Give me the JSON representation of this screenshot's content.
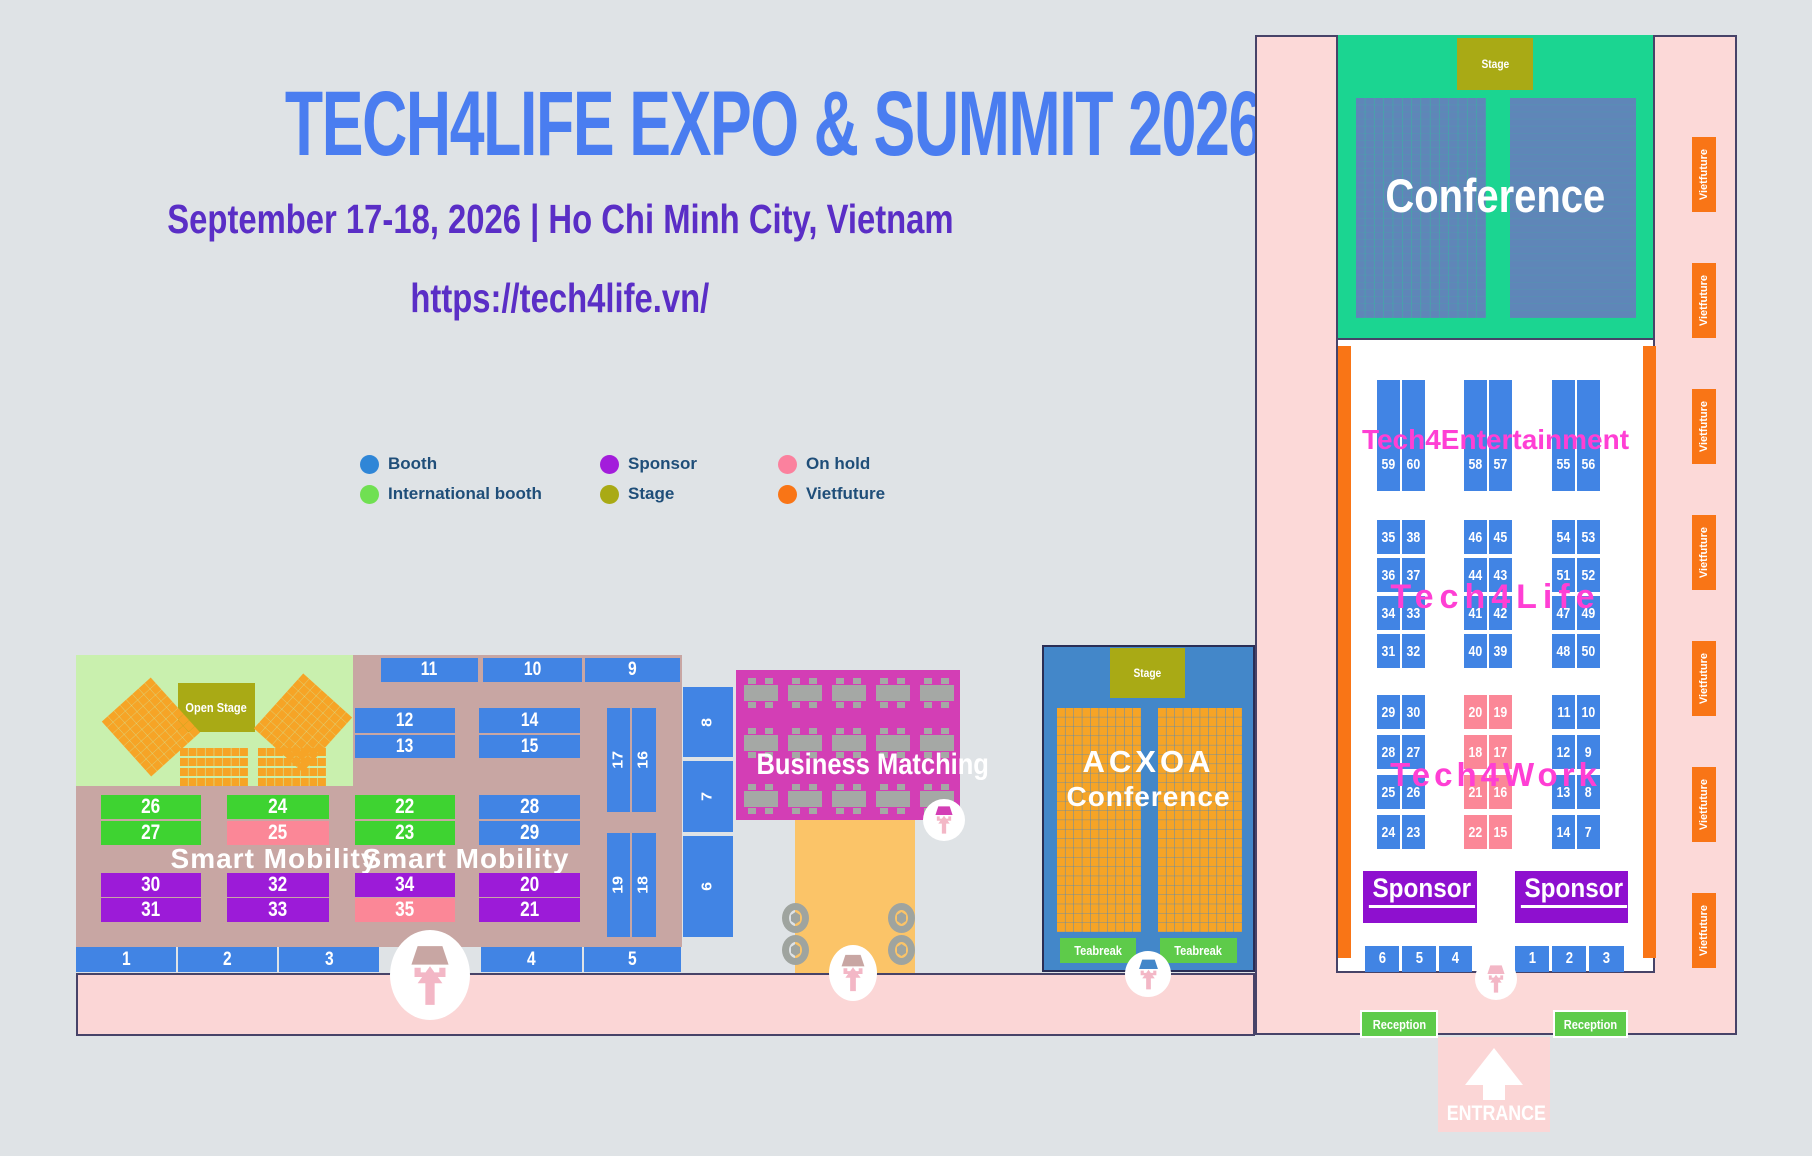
{
  "header": {
    "title": "TECH4LIFE EXPO & SUMMIT 2026",
    "subtitle": "September 17-18, 2026 | Ho Chi Minh City, Vietnam",
    "url": "https://tech4life.vn/"
  },
  "legend": {
    "items": [
      {
        "label": "Booth",
        "color": "#2f86d7"
      },
      {
        "label": "International booth",
        "color": "#70e052"
      },
      {
        "label": "Sponsor",
        "color": "#a31ddb"
      },
      {
        "label": "Stage",
        "color": "#a9aa15"
      },
      {
        "label": "On hold",
        "color": "#fb819e"
      },
      {
        "label": "Vietfuture",
        "color": "#f97516"
      }
    ]
  },
  "colors": {
    "booth": "#4184e4",
    "international": "#3ed331",
    "sponsor": "#9c1bd8",
    "onhold": "#fb8797",
    "stage": "#a9aa15",
    "vietfuture": "#f97516",
    "hall_green": "#1bd591",
    "acxoa_blue": "#4387c9",
    "business_magenta": "#d33eb5",
    "zone_label_magenta": "#ff3fd4",
    "tan": "#c8a6a3",
    "light_green": "#c9f0ae",
    "corridor_orange": "#fbc468",
    "pink_building": "#fcd9d8",
    "pink_walkway": "#fbd6d6",
    "reception_green": "#5ecb4a",
    "seat_orange": "#f6a426",
    "seat_blue": "#5f86b8",
    "title_blue": "#4a7df0",
    "subtitle_purple": "#5a2ec6",
    "legend_text": "#1f4e79",
    "border_navy": "#474368",
    "table_gray": "#a5a8a5"
  },
  "left_hall": {
    "open_stage_label": "Open Stage",
    "smart_mobility_labels": [
      "Smart Mobility",
      "Smart Mobility"
    ],
    "booths": [
      {
        "label": "11",
        "type": "booth"
      },
      {
        "label": "10",
        "type": "booth"
      },
      {
        "label": "9",
        "type": "booth"
      },
      {
        "label": "12",
        "type": "booth"
      },
      {
        "label": "13",
        "type": "booth"
      },
      {
        "label": "14",
        "type": "booth"
      },
      {
        "label": "15",
        "type": "booth"
      },
      {
        "label": "17",
        "type": "booth"
      },
      {
        "label": "16",
        "type": "booth"
      },
      {
        "label": "19",
        "type": "booth"
      },
      {
        "label": "18",
        "type": "booth"
      },
      {
        "label": "8",
        "type": "booth"
      },
      {
        "label": "7",
        "type": "booth"
      },
      {
        "label": "6",
        "type": "booth"
      },
      {
        "label": "1",
        "type": "booth"
      },
      {
        "label": "2",
        "type": "booth"
      },
      {
        "label": "3",
        "type": "booth"
      },
      {
        "label": "4",
        "type": "booth"
      },
      {
        "label": "5",
        "type": "booth"
      }
    ],
    "block_booths": [
      {
        "label": "26",
        "type": "international"
      },
      {
        "label": "27",
        "type": "international"
      },
      {
        "label": "24",
        "type": "international"
      },
      {
        "label": "25",
        "type": "onhold"
      },
      {
        "label": "22",
        "type": "international"
      },
      {
        "label": "23",
        "type": "international"
      },
      {
        "label": "28",
        "type": "booth"
      },
      {
        "label": "29",
        "type": "booth"
      },
      {
        "label": "30",
        "type": "sponsor"
      },
      {
        "label": "31",
        "type": "sponsor"
      },
      {
        "label": "32",
        "type": "sponsor"
      },
      {
        "label": "33",
        "type": "sponsor"
      },
      {
        "label": "34",
        "type": "sponsor"
      },
      {
        "label": "35",
        "type": "onhold"
      },
      {
        "label": "20",
        "type": "sponsor"
      },
      {
        "label": "21",
        "type": "sponsor"
      }
    ]
  },
  "business_matching": {
    "label": "Business Matching",
    "table_rows": 3,
    "table_cols": 5
  },
  "acxoa": {
    "stage_label": "Stage",
    "line1": "ACXOA",
    "line2": "Conference",
    "teabreaks": [
      "Teabreak",
      "Teabreak"
    ]
  },
  "right_hall": {
    "conference_label": "Conference",
    "stage_label": "Stage",
    "vietfuture_tabs": [
      "Vietfuture",
      "Vietfuture",
      "Vietfuture",
      "Vietfuture",
      "Vietfuture",
      "Vietfuture",
      "Vietfuture"
    ],
    "zones": [
      {
        "label": "Tech4Entertainment",
        "groups": [
          [
            [
              "59",
              "60"
            ]
          ],
          [
            [
              "58",
              "57"
            ]
          ],
          [
            [
              "55",
              "56"
            ]
          ]
        ]
      },
      {
        "label": "Tech4Life",
        "groups": [
          [
            [
              "35",
              "38"
            ],
            [
              "36",
              "37"
            ],
            [
              "34",
              "33"
            ],
            [
              "31",
              "32"
            ]
          ],
          [
            [
              "46",
              "45"
            ],
            [
              "44",
              "43"
            ],
            [
              "41",
              "42"
            ],
            [
              "40",
              "39"
            ]
          ],
          [
            [
              "54",
              "53"
            ],
            [
              "51",
              "52"
            ],
            [
              "47",
              "49"
            ],
            [
              "48",
              "50"
            ]
          ]
        ]
      },
      {
        "label": "Tech4Work",
        "group_types": [
          "booth",
          "onhold",
          "booth"
        ],
        "groups": [
          [
            [
              "29",
              "30"
            ],
            [
              "28",
              "27"
            ],
            [
              "25",
              "26"
            ],
            [
              "24",
              "23"
            ]
          ],
          [
            [
              "20",
              "19"
            ],
            [
              "18",
              "17"
            ],
            [
              "21",
              "16"
            ],
            [
              "22",
              "15"
            ]
          ],
          [
            [
              "11",
              "10"
            ],
            [
              "12",
              "9"
            ],
            [
              "13",
              "8"
            ],
            [
              "14",
              "7"
            ]
          ]
        ]
      }
    ],
    "sponsors": [
      "Sponsor",
      "Sponsor"
    ],
    "bottom_rows": [
      [
        "6",
        "5",
        "4"
      ],
      [
        "1",
        "2",
        "3"
      ]
    ],
    "receptions": [
      "Reception",
      "Reception"
    ],
    "entrance_label": "ENTRANCE"
  }
}
